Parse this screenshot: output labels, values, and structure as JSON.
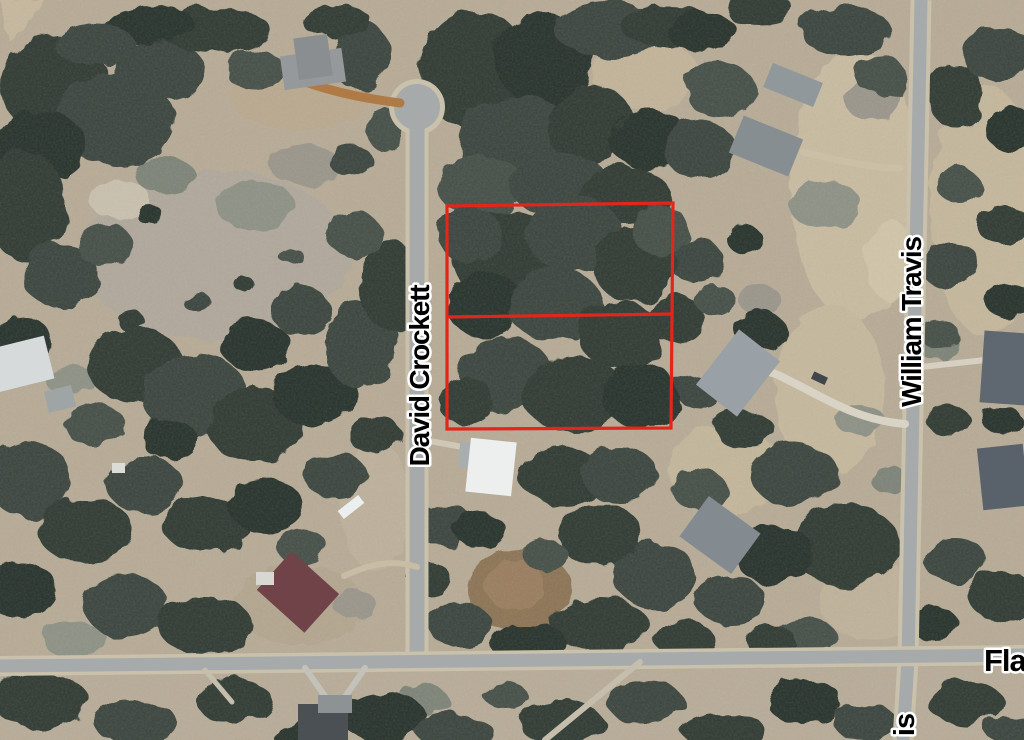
{
  "map": {
    "description": "Aerial satellite view of wooded residential lots with two parcels outlined in red",
    "street_labels": [
      {
        "id": "david-crockett",
        "text": "David Crockett",
        "orientation": "vertical"
      },
      {
        "id": "william-travis",
        "text": "William Travis",
        "orientation": "vertical"
      },
      {
        "id": "fla-partial",
        "text": "Fla",
        "orientation": "horizontal",
        "truncated": true
      },
      {
        "id": "travis-partial",
        "text": "is",
        "orientation": "vertical",
        "truncated": true
      }
    ],
    "parcel": {
      "outline_color": "#e2261b",
      "lot_count": 2
    }
  },
  "colors": {
    "label_fill": "#000000",
    "label_stroke": "#ffffff",
    "ground": "#b7ab96",
    "road": "#a6aaab",
    "road_shoulder": "#c9c1ab"
  }
}
